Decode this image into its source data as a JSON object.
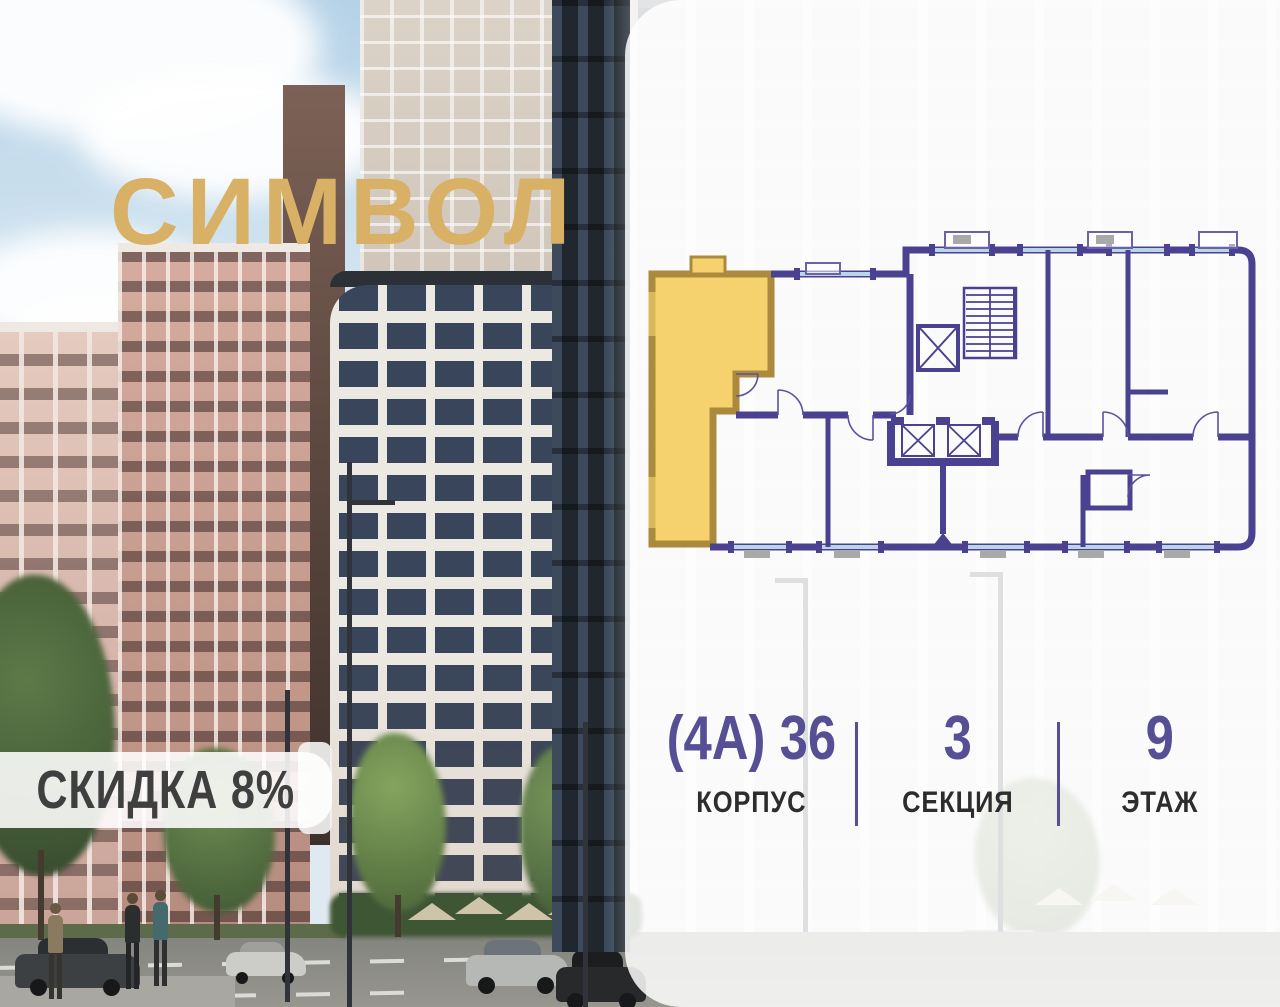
{
  "brand": {
    "logo_text": "СИМВОЛ"
  },
  "badge": {
    "label": "СКИДКА 8%"
  },
  "listing": {
    "stats": [
      {
        "value": "(4А) 36",
        "label": "КОРПУС"
      },
      {
        "value": "3",
        "label": "СЕКЦИЯ"
      },
      {
        "value": "9",
        "label": "ЭТАЖ"
      }
    ]
  },
  "floor_plan": {
    "highlighted_unit_color": "#f6d26e",
    "highlighted_unit_border": "#ab8a3e",
    "wall_color": "#4a4191",
    "window_color": "#b9d5e8"
  },
  "colors": {
    "accent_gold": "#d8b166",
    "stat_purple": "#564f96",
    "badge_text": "#3f3f3f",
    "panel_bg": "rgba(255,255,255,0.85)"
  }
}
